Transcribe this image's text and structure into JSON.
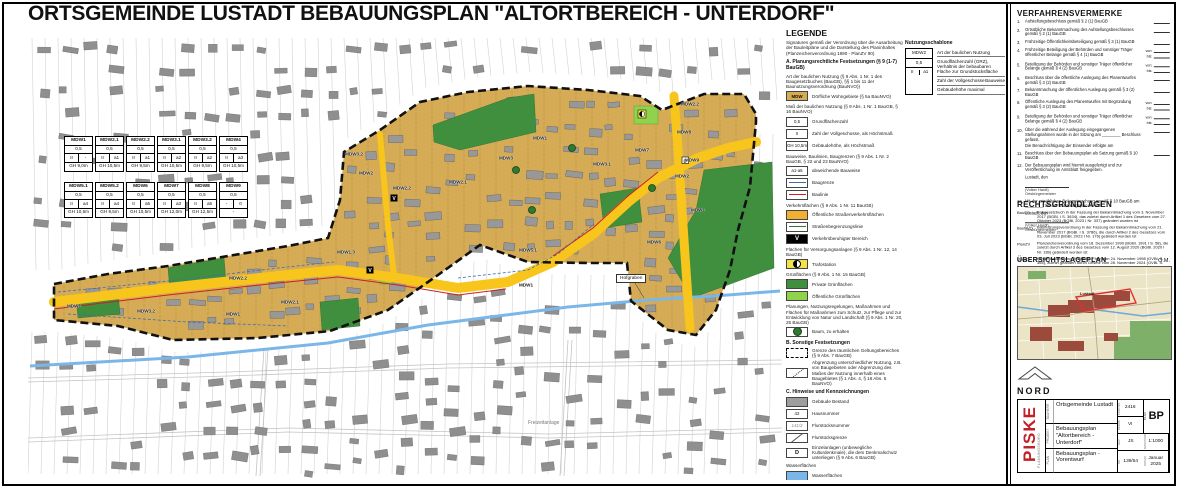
{
  "title": "ORTSGEMEINDE LUSTADT BEBAUUNGSPLAN \"ALTORTBEREICH - UNTERDORF\"",
  "colors": {
    "mdw_area": "#d6ab55",
    "road_yellow": "#f7c51c",
    "legend_orange": "#f2b033",
    "private_green": "#3f8f3f",
    "public_green": "#90d14e",
    "water_blue": "#7ab7e8",
    "building_grey": "#9a9a9a",
    "boundary_black": "#111111",
    "baulinie_red": "#cc2020",
    "baugrenze_blue": "#3a6fb5",
    "logo_red": "#c22026"
  },
  "map": {
    "zone_tables": [
      {
        "name": "MDW1",
        "grz": "0,5",
        "floors": "II",
        "bw": "-",
        "gh": "GH 9,0m"
      },
      {
        "name": "MDW2.1",
        "grz": "0,5",
        "floors": "II",
        "bw": "a1",
        "gh": "GH 10,5m"
      },
      {
        "name": "MDW2.2",
        "grz": "0,5",
        "floors": "II",
        "bw": "a1",
        "gh": "GH 9,5m"
      },
      {
        "name": "MDW3.1",
        "grz": "0,5",
        "floors": "II",
        "bw": "a2",
        "gh": "GH 10,5m"
      },
      {
        "name": "MDW3.2",
        "grz": "0,5",
        "floors": "II",
        "bw": "a2",
        "gh": "GH 9,5m"
      },
      {
        "name": "MDW4",
        "grz": "0,5",
        "floors": "II",
        "bw": "a3",
        "gh": "GH 10,5m"
      },
      {
        "name": "MDW5.1",
        "grz": "0,5",
        "floors": "II",
        "bw": "a4",
        "gh": "GH 10,5m"
      },
      {
        "name": "MDW5.2",
        "grz": "0,5",
        "floors": "II",
        "bw": "a4",
        "gh": "GH 9,5m"
      },
      {
        "name": "MDW6",
        "grz": "0,5",
        "floors": "II",
        "bw": "a5",
        "gh": "GH 10,5m"
      },
      {
        "name": "MDW7",
        "grz": "0,5",
        "floors": "II",
        "bw": "a3",
        "gh": "GH 12,0m"
      },
      {
        "name": "MDW8",
        "grz": "0,5",
        "floors": "II",
        "bw": "a5",
        "gh": "GH 12,5m"
      },
      {
        "name": "MDW9",
        "grz": "0,5",
        "floors": "-",
        "bw": "0",
        "gh": "-"
      }
    ],
    "labels": [
      {
        "t": "MDW1",
        "x": 46,
        "y": 276
      },
      {
        "t": "MDW3.2",
        "x": 118,
        "y": 281
      },
      {
        "t": "MDW1",
        "x": 205,
        "y": 284
      },
      {
        "t": "MDW2.1",
        "x": 262,
        "y": 272
      },
      {
        "t": "MDW2.2",
        "x": 210,
        "y": 248
      },
      {
        "t": "MDW2",
        "x": 338,
        "y": 143
      },
      {
        "t": "MDW3.2",
        "x": 326,
        "y": 124
      },
      {
        "t": "MDW2.2",
        "x": 374,
        "y": 158
      },
      {
        "t": "MDW2.1",
        "x": 430,
        "y": 152
      },
      {
        "t": "MDW1.3",
        "x": 318,
        "y": 222
      },
      {
        "t": "MDW3",
        "x": 478,
        "y": 128
      },
      {
        "t": "MDW1",
        "x": 512,
        "y": 108
      },
      {
        "t": "MDW5.1",
        "x": 500,
        "y": 220
      },
      {
        "t": "MDW1",
        "x": 498,
        "y": 255
      },
      {
        "t": "MDW6",
        "x": 626,
        "y": 212
      },
      {
        "t": "MDW7",
        "x": 614,
        "y": 120
      },
      {
        "t": "MDW8",
        "x": 656,
        "y": 102
      },
      {
        "t": "MDW9",
        "x": 664,
        "y": 130
      },
      {
        "t": "MDW2.2",
        "x": 662,
        "y": 74
      },
      {
        "t": "MDW3.1",
        "x": 574,
        "y": 134
      },
      {
        "t": "MDW2",
        "x": 654,
        "y": 146
      },
      {
        "t": "MDW1",
        "x": 670,
        "y": 180
      }
    ],
    "annotations": {
      "stream": "Hofgraben",
      "leisure_area": "Freizeitanlage"
    }
  },
  "legend": {
    "heading": "LEGENDE",
    "intro": "Signaturen gemäß der Verordnung über die Ausarbeitung der Bauleitpläne und die Darstellung des Planinhaltes (Planzeichenverordnung 1990 - PlanZV 90)",
    "entries": [
      {
        "kind": "section",
        "label": "A.  Planungsrechtliche Festsetzungen (§ 9 (1-7) BauGB)"
      },
      {
        "kind": "header",
        "label": "Art der baulichen Nutzung (§ 9 Abs. 1 Nr. 1 des Baugesetzbuches (BauGB), §§ 1 bis 11 der Baunutzungsverordnung (BauNVO))"
      },
      {
        "kind": "item",
        "swatch": "mdw",
        "glyph": "MDW",
        "label": "Dörfliche Wohngebiete (§ 5a BauNVO)"
      },
      {
        "kind": "header",
        "label": "Maß der baulichen Nutzung (§ 9 Abs. 1 Nr. 1 BauGB, § 16 BauNVO)"
      },
      {
        "kind": "item",
        "swatch": "text",
        "glyph": "0,5",
        "label": "Grundflächenzahl"
      },
      {
        "kind": "item",
        "swatch": "text",
        "glyph": "II",
        "label": "Zahl der Vollgeschosse, als Höchstmaß"
      },
      {
        "kind": "item",
        "swatch": "text",
        "glyph": "GH 10,5m",
        "label": "Gebäudehöhe, als Höchstmaß"
      },
      {
        "kind": "header",
        "label": "Bauweise, Baulinien, Baugrenzen (§ 9 Abs. 1 Nr. 2 BauGB, § 22 und 23 BauNVO)"
      },
      {
        "kind": "item",
        "swatch": "text",
        "glyph": "a1-a5",
        "label": "abweichende Bauweise"
      },
      {
        "kind": "item",
        "swatch": "line-blue",
        "label": "Baugrenze"
      },
      {
        "kind": "item",
        "swatch": "line-red",
        "label": "Baulinie"
      },
      {
        "kind": "header",
        "label": "Verkehrsflächen (§ 9 Abs. 1 Nr. 11 BauGB)"
      },
      {
        "kind": "item",
        "swatch": "fill-orange",
        "label": "Öffentliche Straßenverkehrsflächen"
      },
      {
        "kind": "item",
        "swatch": "line-green",
        "label": "Straßenbegrenzungslinie"
      },
      {
        "kind": "item",
        "swatch": "vbox",
        "glyph": "V",
        "label": "Verkehrsberuhigter Bereich"
      },
      {
        "kind": "header",
        "label": "Flächen für Versorgungsanlagen (§ 9 Abs. 1 Nr. 12, 14 BauGB)"
      },
      {
        "kind": "item",
        "swatch": "trafo",
        "label": "Trafostation"
      },
      {
        "kind": "header",
        "label": "Grünflächen (§ 9 Abs. 1 Nr. 15 BauGB)"
      },
      {
        "kind": "item",
        "swatch": "fill-dgreen",
        "label": "Private Grünflächen"
      },
      {
        "kind": "item",
        "swatch": "fill-lgreen",
        "label": "Öffentliche Grünflächen"
      },
      {
        "kind": "header",
        "label": "Planungen, Nutzungsregelungen, Maßnahmen und Flächen für Maßnahmen zum Schutz, zur Pflege und zur Entwicklung von Natur und Landschaft (§ 9 Abs. 1 Nr. 20, 25 BauGB)"
      },
      {
        "kind": "item",
        "swatch": "tree",
        "label": "Baum, zu erhalten"
      },
      {
        "kind": "section",
        "label": "B.  Sonstige Festsetzungen"
      },
      {
        "kind": "item",
        "swatch": "dash",
        "label": "Grenze des räumlichen Geltungsbereiches (§ 9 Abs. 7 BauGB)"
      },
      {
        "kind": "item",
        "swatch": "abgrenz",
        "label": "Abgrenzung unterschiedlicher Nutzung, z.B. von Baugebieten oder Abgrenzung des Maßes der Nutzung innerhalb eines Baugebietes (§ 1 Abs. 4, § 16 Abs. 5 BauNVO)"
      },
      {
        "kind": "section",
        "label": "C.  Hinweise und Kennzeichnungen"
      },
      {
        "kind": "item",
        "swatch": "fill-grey",
        "label": "Gebäude Bestand"
      },
      {
        "kind": "item",
        "swatch": "text",
        "glyph": "42",
        "label": "Hausnummer"
      },
      {
        "kind": "item",
        "swatch": "pnum",
        "glyph": "141/3",
        "label": "Flurstücksnummer"
      },
      {
        "kind": "item",
        "swatch": "pline",
        "label": "Flurstücksgrenze"
      },
      {
        "kind": "item",
        "swatch": "denkmal",
        "glyph": "D",
        "label": "Einzelanlagen (unbewegliche Kulturdenkmale), die dem Denkmalschutz unterliegen (§ 9 Abs. 6 BauGB)"
      },
      {
        "kind": "header",
        "label": "Wasserflächen"
      },
      {
        "kind": "item",
        "swatch": "fill-water",
        "label": "Wasserflächen"
      }
    ],
    "schablone": {
      "heading": "Nutzungsschablone",
      "cells": {
        "art": "MDW2",
        "grz": "0,5",
        "floors": "II",
        "bw": "a1"
      },
      "labels": {
        "art": "Art der baulichen Nutzung",
        "grz": "Grundflächenzahl (GRZ), Verhältnis der bebaubaren Fläche zur Grundstücksfläche",
        "floors": "Zahl der Vollgeschosse",
        "bw": "Bauweise",
        "gh": "Gebäudehöhe maximal"
      }
    }
  },
  "verfahrensvermerke": {
    "heading": "VERFAHRENSVERMERKE",
    "sig_place": "Lustadt, den",
    "sig_name": "(Volker Hardt)",
    "sig_role": "Ortsbürgermeister",
    "items": [
      {
        "no": "1.",
        "text": "Aufstellungsbeschluss gemäß § 2 (1) BauGB",
        "dates": [
          ""
        ]
      },
      {
        "no": "2.",
        "text": "Ortsübliche Bekanntmachung des Aufstellungsbeschlusses gemäß § 2 (1) BauGB",
        "dates": [
          ""
        ]
      },
      {
        "no": "3.",
        "text": "Frühzeitige Öffentlichkeitsbeteiligung gemäß § 3 (1) BauGB",
        "dates": [
          ""
        ]
      },
      {
        "no": "4.",
        "text": "Frühzeitige Beteiligung der Behörden und sonstiger Träger öffentlicher Belange gemäß § 4 (1) BauGB",
        "dates": [
          "von:",
          "bis:"
        ]
      },
      {
        "no": "5.",
        "text": "Beteiligung der Behörden und sonstiger Träger öffentlicher Belange gemäß § 4 (2) BauGB",
        "dates": [
          "von:",
          "bis:"
        ]
      },
      {
        "no": "6.",
        "text": "Beschluss über die öffentliche Auslegung des Planentwurfes gemäß § 3 (2) BauGB",
        "dates": [
          ""
        ]
      },
      {
        "no": "7.",
        "text": "Bekanntmachung der öffentlichen Auslegung gemäß § 3 (2) BauGB",
        "dates": [
          ""
        ]
      },
      {
        "no": "8.",
        "text": "Öffentliche Auslegung des Planentwurfes mit Begründung gemäß § 3 (2) BauGB",
        "dates": [
          "von:",
          "bis:"
        ]
      },
      {
        "no": "9.",
        "text": "Beteiligung der Behörden und sonstiger Träger öffentlicher Belange gemäß § 4 (2) BauGB",
        "dates": [
          "von:",
          "bis:"
        ]
      },
      {
        "no": "10.",
        "text": "Über die während der Auslegung eingegangenen Stellungnahmen wurde in der Sitzung am ________ Beschluss gefasst.",
        "extra": "Die Benachrichtigung der Einsender erfolgte am",
        "dates": [
          ""
        ]
      },
      {
        "no": "11.",
        "text": "Beschluss über den Bebauungsplan als Satzung gemäß § 10 BauGB",
        "dates": [
          ""
        ]
      },
      {
        "no": "12.",
        "text": "Der Bebauungsplan wird hiermit ausgefertigt und zur Veröffentlichung im Amtsblatt freigegeben.",
        "sig": true
      },
      {
        "no": "13.",
        "text": "Mit der ortsüblichen Bekanntmachung gemäß § 10 BauGB am ________ tritt der Bebauungsplan in Kraft.",
        "sig": true
      }
    ]
  },
  "rechtsgrundlagen": {
    "heading": "RECHTSGRUNDLAGEN",
    "entries": [
      {
        "abbr": "BauGB",
        "text": "Baugesetzbuch in der Fassung der Bekanntmachung vom 3. November 2017 (BGBl. I S. 3634), das zuletzt durch Artikel 1 des Gesetzes vom 27. Oktober 2023 (BGBl. 2023 I Nr. 337) geändert worden ist"
      },
      {
        "abbr": "BauNVO",
        "text": "Baunutzungsverordnung in der Fassung der Bekanntmachung vom 21. November 2017 (BGBl. I S. 3786), die durch Artikel 2 des Gesetzes vom 03. Juli 2023 (BGBl. 2023 I Nr. 176) geändert worden ist"
      },
      {
        "abbr": "PlanZV",
        "text": "Planzeichenverordnung vom 18. Dezember 1990 (BGBl. 1991 I S. 58), die zuletzt durch Artikel 3 des Gesetzes vom 12. August 2020 (BGBl. 2020 I Nr. 189) geändert worden ist"
      },
      {
        "abbr": "LBauO",
        "text": "Landesbauordnung Rheinland-Pfalz vom 24. November 1998 (GVBl. S. 365), zuletzt geändert durch Gesetz vom 28. November 2024 (GVBl. S. 365)"
      }
    ]
  },
  "uebersicht": {
    "heading": "ÜBERSICHTSLAGEPLAN",
    "scale_note": "O.M.",
    "place_label": "Lustadt"
  },
  "north_label": "NORD",
  "titleblock": {
    "logo": "PISKE",
    "logo_sub": "PLANUNGSBÜRO",
    "rows": [
      {
        "label": "BAUHERR",
        "value": "Ortsgemeinde Lustadt"
      },
      {
        "label": "PROJEKT",
        "value": "Bebauungsplan \"Altortbereich - Unterdorf\""
      },
      {
        "label": "PLAN",
        "value": "Bebauungsplan - Vorentwurf"
      }
    ],
    "meta": [
      {
        "label": "PROJ.NR.",
        "value": "2416"
      },
      {
        "label": "PLAN",
        "value": "BP"
      },
      {
        "label": "BEARB.",
        "value": "VI"
      },
      {
        "label": "GEZ.",
        "value": "JS"
      },
      {
        "label": "MASSSTAB",
        "value": "1:1000"
      },
      {
        "label": "NR.",
        "value": "139/54"
      },
      {
        "label": "DATUM",
        "value": "Januar 2025"
      }
    ]
  }
}
